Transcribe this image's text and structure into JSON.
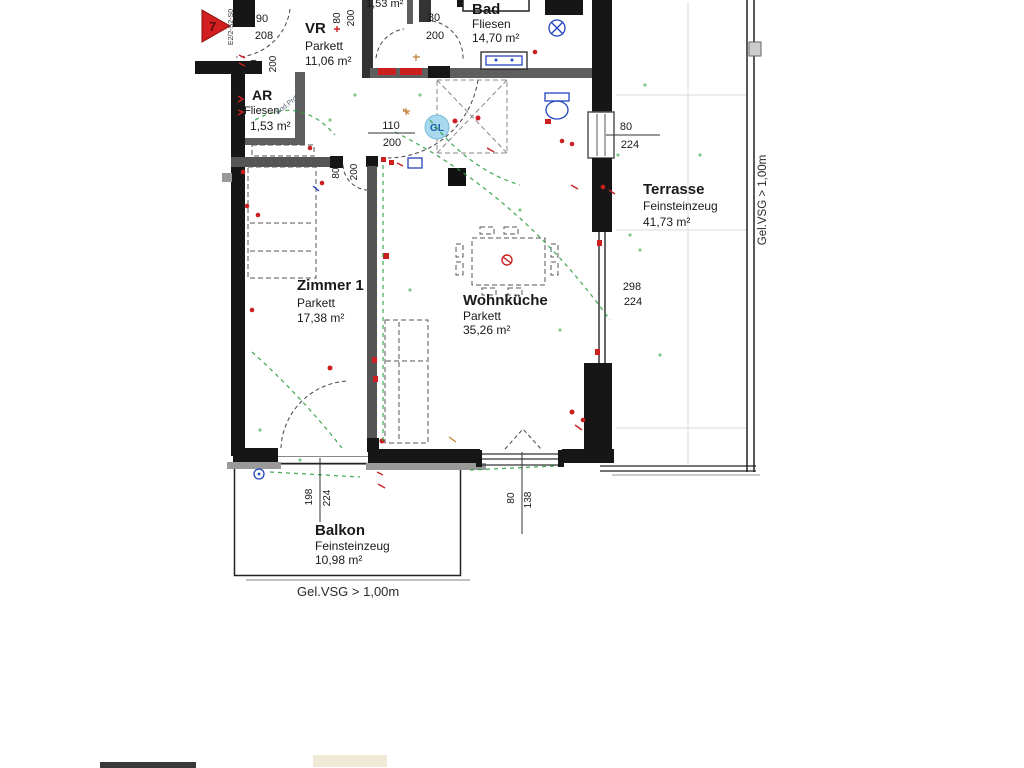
{
  "plan": {
    "marker": {
      "number": "7",
      "code": "E2/2-S2-S0"
    },
    "rooms": {
      "vr": {
        "name": "VR",
        "floor": "Parkett",
        "area": "11,06 m²"
      },
      "ar": {
        "name": "AR",
        "floor": "Fliesen",
        "area": "1,53 m²"
      },
      "bad": {
        "name": "Bad",
        "floor": "Fliesen",
        "area": "14,70 m²"
      },
      "zimmer1": {
        "name": "Zimmer 1",
        "floor": "Parkett",
        "area": "17,38 m²"
      },
      "wohnkueche": {
        "name": "Wohnküche",
        "floor": "Parkett",
        "area": "35,26 m²"
      },
      "terrasse": {
        "name": "Terrasse",
        "floor": "Feinsteinzeug",
        "area": "41,73 m²"
      },
      "balkon": {
        "name": "Balkon",
        "floor": "Feinsteinzeug",
        "area": "10,98 m²"
      }
    },
    "top_room_area": "1,53 m²",
    "dims": {
      "door_entry": {
        "w": "90",
        "h": "208"
      },
      "door_ar": {
        "w": "80",
        "h": "200"
      },
      "door_top": {
        "w": "80",
        "h": "200"
      },
      "door_bad": {
        "w": "80",
        "h": "200"
      },
      "door_wohnkueche": {
        "w": "110",
        "h": "200"
      },
      "window_right": {
        "w": "80",
        "h": "224"
      },
      "door_terrasse": {
        "w": "298",
        "h": "224"
      },
      "door_zimmer1": {
        "w": "80",
        "h": "200"
      },
      "door_balkon": {
        "w": "198",
        "h": "224"
      },
      "window_bottom": {
        "w": "80",
        "h": "138"
      }
    },
    "labels": {
      "gl": "GL",
      "railing_right": "Gel.VSG > 1,00m",
      "railing_bottom": "Gel.VSG > 1,00m",
      "ar_note": "Bod.Prd.+"
    },
    "colors": {
      "wall": "#161616",
      "wall_light": "#5e5e5e",
      "electric": "#cc2020",
      "cable": "#2e9e40",
      "sanitary": "#2244bb",
      "gl_fill": "#a9d9ee",
      "marker": "#d21f1f"
    }
  }
}
